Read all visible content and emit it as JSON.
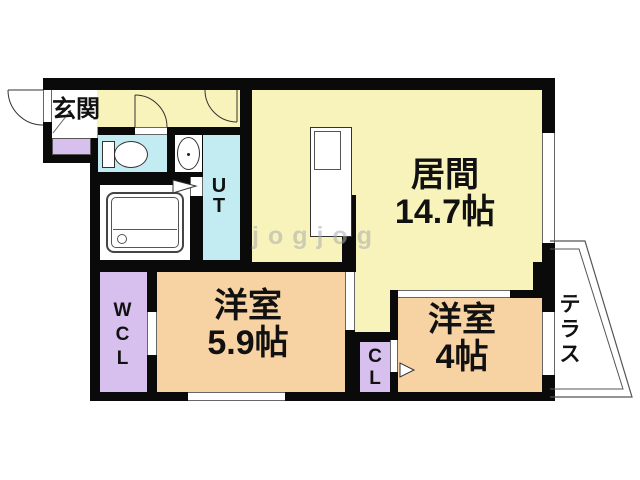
{
  "watermark": "jogjog",
  "rooms": {
    "genkan": {
      "label": "玄関"
    },
    "living": {
      "name": "居間",
      "size": "14.7帖"
    },
    "bedroom1": {
      "name": "洋室",
      "size": "5.9帖"
    },
    "bedroom2": {
      "name": "洋室",
      "size": "4帖"
    },
    "wcl": {
      "label": "WCL"
    },
    "cl": {
      "label": "CL"
    },
    "ut": {
      "label": "UT"
    },
    "terrace": {
      "label": "テラス"
    }
  },
  "colors": {
    "wall": "#0a0a0a",
    "floor_yellow": "#f8f3ba",
    "floor_orange": "#f7d2a2",
    "floor_cyan": "#c2ecf2",
    "floor_purple": "#d7bfee"
  }
}
